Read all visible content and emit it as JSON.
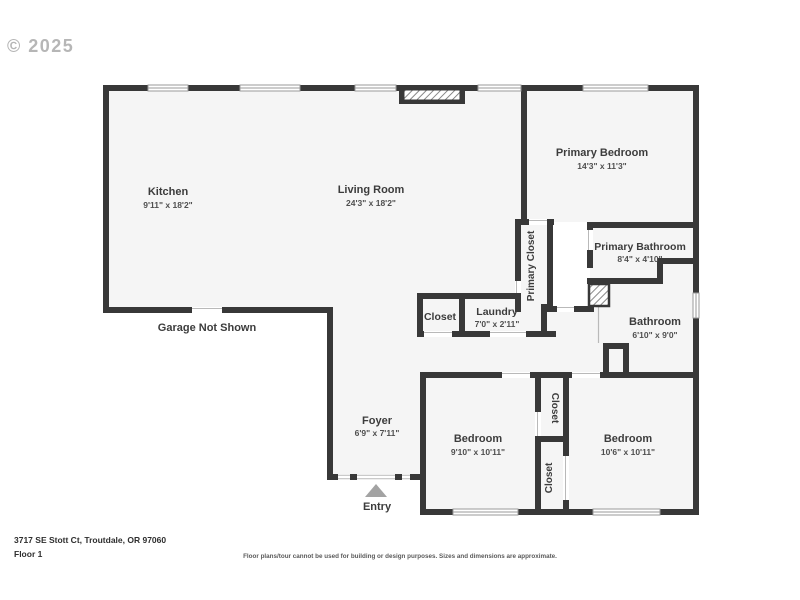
{
  "watermark": "© 2025",
  "rooms": {
    "kitchen": {
      "name": "Kitchen",
      "dims": "9'11\" x 18'2\""
    },
    "living_room": {
      "name": "Living Room",
      "dims": "24'3\" x 18'2\""
    },
    "primary_bedroom": {
      "name": "Primary Bedroom",
      "dims": "14'3\" x 11'3\""
    },
    "primary_closet": {
      "name": "Primary Closet"
    },
    "primary_bathroom": {
      "name": "Primary Bathroom",
      "dims": "8'4\" x 4'10\""
    },
    "hall_closet": {
      "name": "Closet"
    },
    "laundry": {
      "name": "Laundry",
      "dims": "7'0\" x 2'11\""
    },
    "bathroom": {
      "name": "Bathroom",
      "dims": "6'10\" x 9'0\""
    },
    "foyer": {
      "name": "Foyer",
      "dims": "6'9\" x 7'11\""
    },
    "bedroom_left": {
      "name": "Bedroom",
      "dims": "9'10\" x 10'11\""
    },
    "bedroom_right": {
      "name": "Bedroom",
      "dims": "10'6\" x 10'11\""
    },
    "closet_top": {
      "name": "Closet"
    },
    "closet_bottom": {
      "name": "Closet"
    }
  },
  "annotations": {
    "garage": "Garage Not Shown",
    "entry": "Entry"
  },
  "footer": {
    "address": "3717 SE Stott Ct, Troutdale, OR 97060",
    "floor": "Floor 1",
    "disclaimer": "Floor plans/tour cannot be used for building or design purposes. Sizes and dimensions are approximate."
  },
  "colors": {
    "wall": "#383838",
    "floor_fill": "#f5f5f5",
    "label_text": "#3c3c3c",
    "watermark": "#b6b6b6",
    "entry_arrow": "#a3a3a3"
  }
}
